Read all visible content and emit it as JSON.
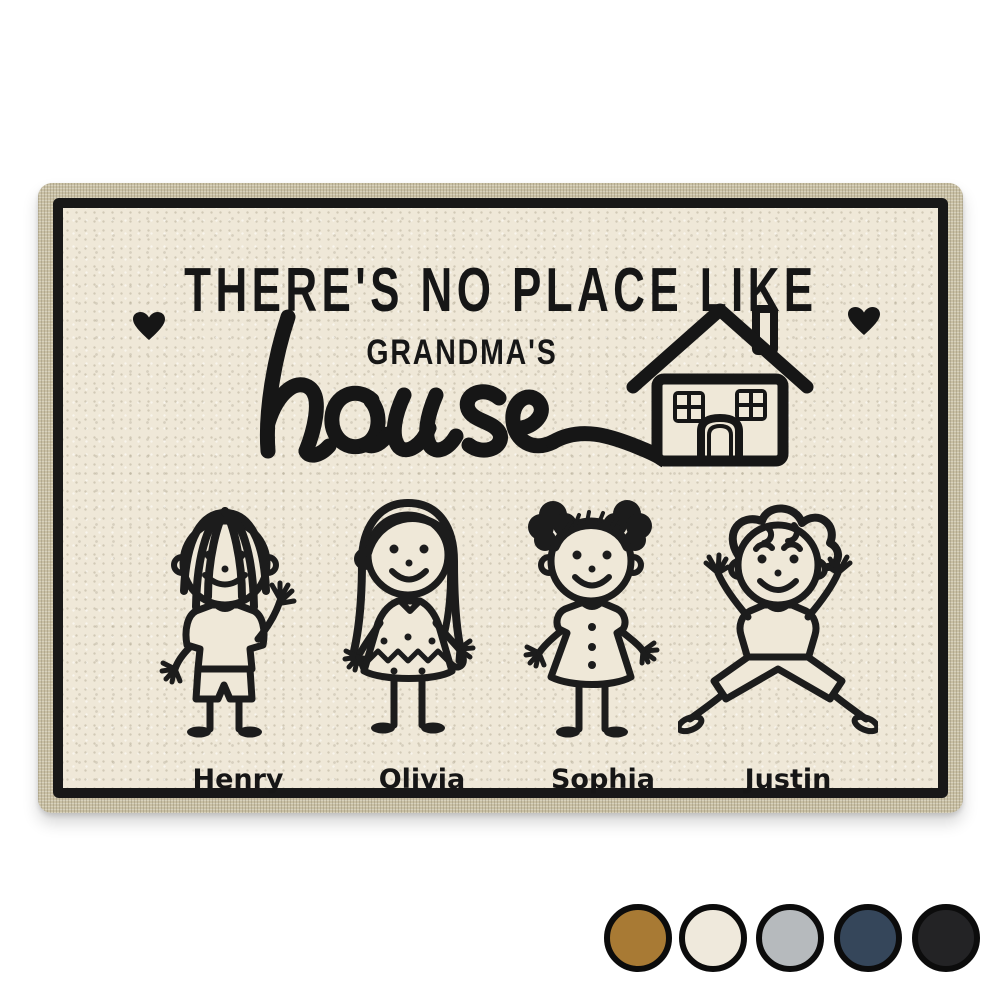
{
  "mat": {
    "line1": "THERE'S NO PLACE LIKE",
    "line2": "GRANDMA'S",
    "line3_script": "house",
    "kids": [
      {
        "name": "Henry"
      },
      {
        "name": "Olivia"
      },
      {
        "name": "Sophia"
      },
      {
        "name": "Justin"
      }
    ],
    "colors": {
      "field_cream": "#efe8d8",
      "trim_beige": "#c9c0a4",
      "frame_ink": "#181818",
      "print_ink": "#161616"
    }
  },
  "swatches": {
    "items": [
      {
        "name": "brown",
        "hex": "#a87a34"
      },
      {
        "name": "cream",
        "hex": "#efe9dc"
      },
      {
        "name": "gray",
        "hex": "#b6babd"
      },
      {
        "name": "navy",
        "hex": "#35465a"
      },
      {
        "name": "black",
        "hex": "#232325"
      }
    ]
  }
}
